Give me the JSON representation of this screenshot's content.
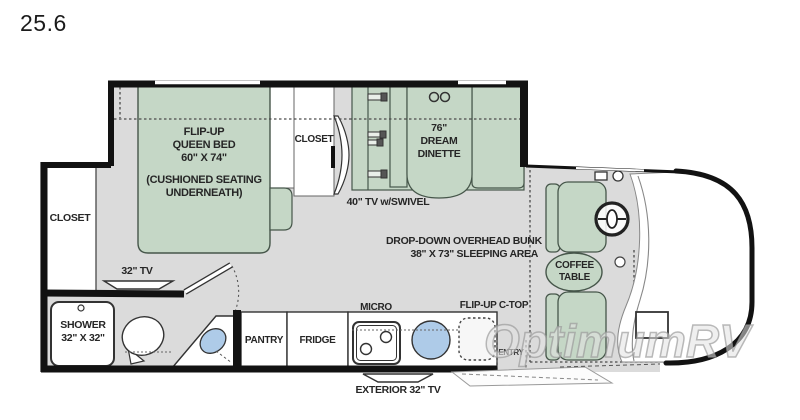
{
  "title": "25.6",
  "watermark": "OptimumRV",
  "colors": {
    "furniture_green": "#c5d7c6",
    "floor_gray": "#dbdbdb",
    "wall_black": "#121212",
    "fixture_blue": "#aecbe8",
    "label_text": "#262626"
  },
  "labels": {
    "bed": {
      "l1": "FLIP-UP",
      "l2": "QUEEN BED",
      "l3": "60\" X 74\"",
      "note1": "(CUSHIONED SEATING",
      "note2": "UNDERNEATH)"
    },
    "closet_rear": "CLOSET",
    "closet_mid": "CLOSET",
    "dinette": {
      "l1": "76\"",
      "l2": "DREAM",
      "l3": "DINETTE"
    },
    "tv_swivel": "40\" TV w/SWIVEL",
    "bunk": {
      "l1": "DROP-DOWN OVERHEAD BUNK",
      "l2": "38\" X 73\" SLEEPING AREA"
    },
    "coffee_table": {
      "l1": "COFFEE",
      "l2": "TABLE"
    },
    "tv_32": "32\" TV",
    "shower": {
      "l1": "SHOWER",
      "l2": "32\" X 32\""
    },
    "pantry": "PANTRY",
    "fridge": "FRIDGE",
    "micro": "MICRO",
    "flip_up_ctop": "FLIP-UP C-TOP",
    "entry": "ENTRY",
    "exterior_tv": "EXTERIOR 32\" TV"
  }
}
